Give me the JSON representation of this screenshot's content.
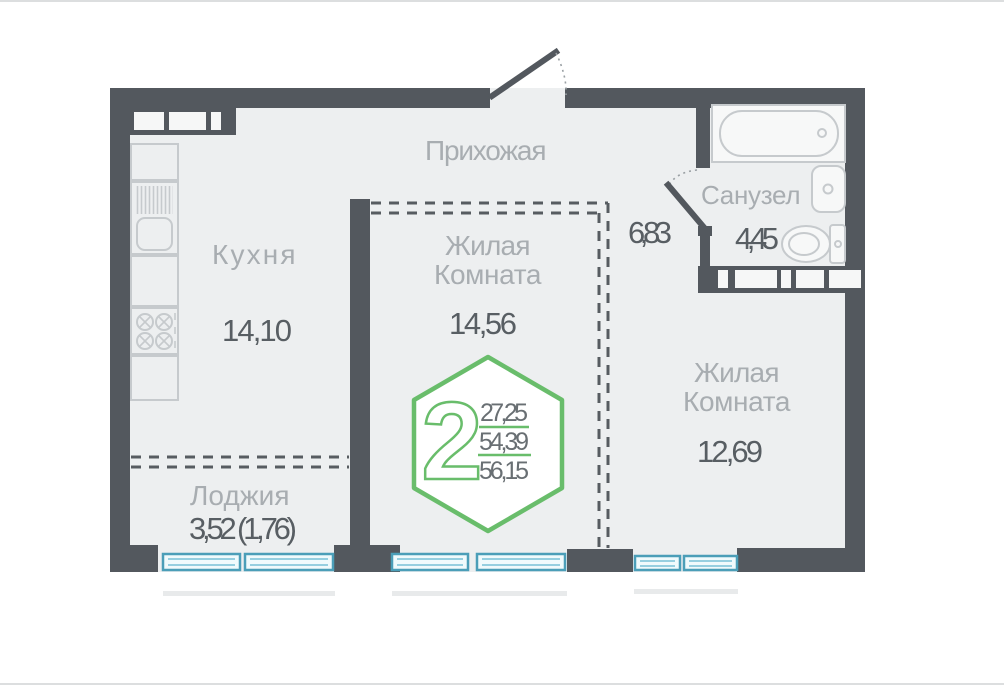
{
  "rooms": {
    "hallway": {
      "label": "Прихожая",
      "area": "6,83"
    },
    "kitchen": {
      "label": "Кухня",
      "area": "14,10"
    },
    "living_center": {
      "label_line1": "Жилая",
      "label_line2": "Комната",
      "area": "14,56"
    },
    "bathroom": {
      "label": "Санузел",
      "area": "4,45"
    },
    "living_right": {
      "label_line1": "Жилая",
      "label_line2": "Комната",
      "area": "12,69"
    },
    "loggia": {
      "label": "Лоджия",
      "area": "3,52 (1,76)"
    }
  },
  "badge": {
    "rooms_count": "2",
    "areas": [
      "27,25",
      "54,39",
      "56,15"
    ]
  },
  "colors": {
    "wall": "#53585e",
    "floor": "#edeff0",
    "accent_green": "#69bd6b",
    "window_frame": "#4b9eb8",
    "room_label": "#a8adb1",
    "area_value": "#585e63",
    "fixture_outline": "#c6cacd"
  }
}
